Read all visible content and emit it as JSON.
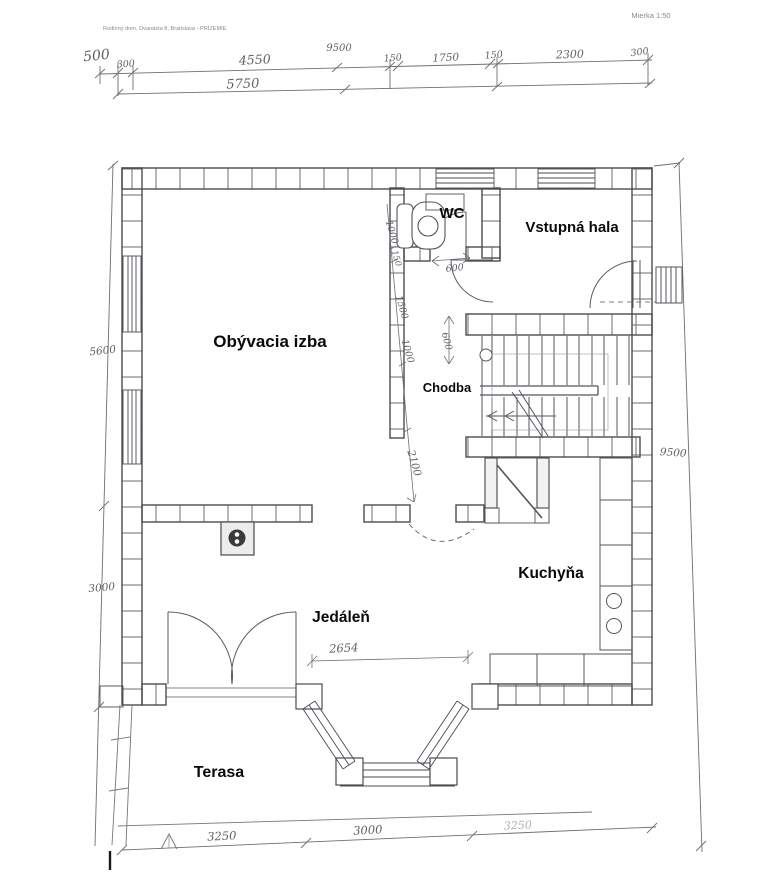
{
  "header": {
    "project": "Rodinný dom, Dvanásta 8, Bratislava - PRÍZEMIE",
    "scale": "Mierka 1:50"
  },
  "rooms": {
    "living": "Obývacia izba",
    "wc": "WC",
    "hall": "Vstupná hala",
    "corridor": "Chodba",
    "kitchen": "Kuchyňa",
    "dining": "Jedáleň",
    "terrace": "Terasa"
  },
  "dims": {
    "offset_left": "500",
    "total_top": "9500",
    "top_chain": [
      "300",
      "4550",
      "150",
      "1750",
      "150",
      "2300",
      "300"
    ],
    "subtotal_top": "5750",
    "left_upper": "5600",
    "left_lower": "3000",
    "right_total": "9500",
    "wc_door": "600",
    "hall_clear": "600",
    "corridor_chain": [
      "1000",
      "150",
      "1500",
      "1000"
    ],
    "corridor_length": "2100",
    "bay_opening": "2654",
    "bottom_chain": [
      "3250",
      "3000",
      "3250"
    ]
  },
  "colors": {
    "paper": "#ffffff",
    "wall_ink": "#4b4b52",
    "pencil": "#75757d",
    "label": "#0a0a0a"
  }
}
